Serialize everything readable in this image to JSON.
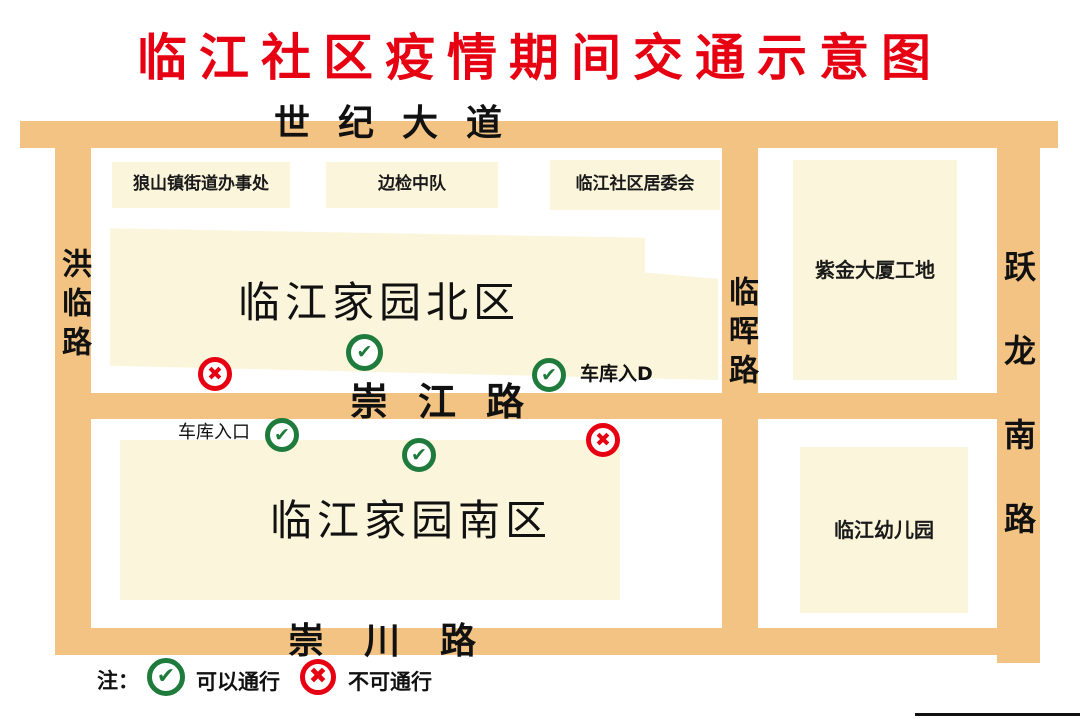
{
  "title": "临江社区疫情期间交通示意图",
  "roads": {
    "century_avenue": "世纪大道",
    "honglin_road": "洪临路",
    "linhui_road": "临晖路",
    "yuelong_south_road": "跃龙南路",
    "chongjiang_road": "崇江路",
    "chongchuan_road": "崇川路"
  },
  "blocks": {
    "langshan_office": "狼山镇街道办事处",
    "border_inspection": "边检中队",
    "community_committee": "临江社区居委会",
    "north_district": "临江家园北区",
    "south_district": "临江家园南区",
    "zijin_site": "紫金大厦工地",
    "kindergarten": "临江幼儿园"
  },
  "labels": {
    "garage_entrance_north": "车库入D",
    "garage_entrance_south": "车库入口"
  },
  "icons": {
    "pass": "✔",
    "no_pass": "✖"
  },
  "legend": {
    "note": "注：",
    "pass": "可以通行",
    "no_pass": "不可通行"
  },
  "colors": {
    "road": "#F2C382",
    "block": "#FBF5DB",
    "title_red": "#E60012",
    "pass_green": "#1E7B3C",
    "no_pass_red": "#E60012"
  }
}
